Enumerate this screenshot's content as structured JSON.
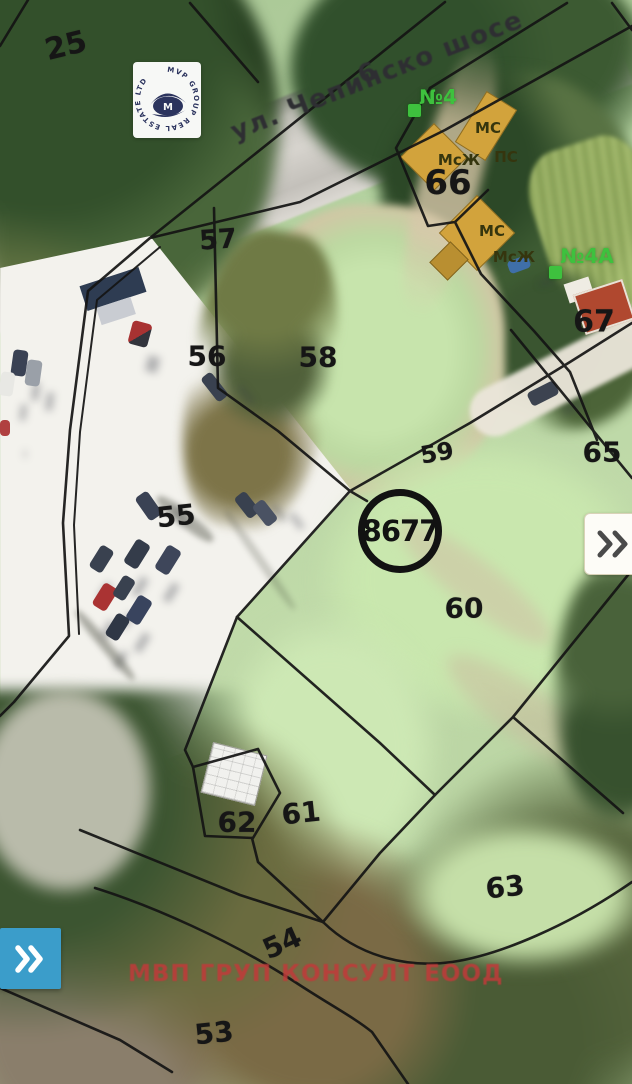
{
  "map": {
    "street_label": "ул. Чепинско шосе",
    "road_parcel_number": "6",
    "highlighted_plot": {
      "number": "8677"
    },
    "parcel_labels": [
      {
        "label": "25",
        "x": 66,
        "y": 46,
        "size": 30,
        "rot": -14
      },
      {
        "label": "57",
        "x": 218,
        "y": 240,
        "size": 27,
        "rot": -4
      },
      {
        "label": "56",
        "x": 207,
        "y": 356,
        "size": 28,
        "rot": 0
      },
      {
        "label": "58",
        "x": 318,
        "y": 357,
        "size": 28,
        "rot": 0
      },
      {
        "label": "55",
        "x": 176,
        "y": 516,
        "size": 28,
        "rot": -6
      },
      {
        "label": "59",
        "x": 437,
        "y": 453,
        "size": 24,
        "rot": -10
      },
      {
        "label": "60",
        "x": 464,
        "y": 608,
        "size": 28,
        "rot": 0
      },
      {
        "label": "62",
        "x": 237,
        "y": 822,
        "size": 28,
        "rot": 0
      },
      {
        "label": "61",
        "x": 301,
        "y": 813,
        "size": 28,
        "rot": -6
      },
      {
        "label": "63",
        "x": 505,
        "y": 887,
        "size": 28,
        "rot": -6
      },
      {
        "label": "54",
        "x": 282,
        "y": 943,
        "size": 28,
        "rot": -24
      },
      {
        "label": "53",
        "x": 214,
        "y": 1033,
        "size": 28,
        "rot": -6
      },
      {
        "label": "65",
        "x": 602,
        "y": 452,
        "size": 28,
        "rot": 0
      },
      {
        "label": "66",
        "x": 448,
        "y": 183,
        "size": 34,
        "rot": 0
      },
      {
        "label": "67",
        "x": 594,
        "y": 322,
        "size": 30,
        "rot": 0
      }
    ],
    "building_labels": [
      {
        "label": "МС",
        "x": 488,
        "y": 128
      },
      {
        "label": "ПС",
        "x": 506,
        "y": 157
      },
      {
        "label": "МсЖ",
        "x": 459,
        "y": 160
      },
      {
        "label": "МС",
        "x": 492,
        "y": 231
      },
      {
        "label": "МсЖ",
        "x": 514,
        "y": 257
      }
    ],
    "address_markers": [
      {
        "label": "№4",
        "sx": 408,
        "sy": 104,
        "tx": 438,
        "ty": 97
      },
      {
        "label": "№4А",
        "sx": 549,
        "sy": 266,
        "tx": 587,
        "ty": 256
      }
    ]
  },
  "watermark": {
    "circle_text": "MVP GROUP REAL ESTATE LTD",
    "monogram": "M",
    "footer": "МВП ГРУП КОНСУЛТ ЕООД"
  },
  "icons": {
    "expand_panel_right": "double-chevron-right",
    "expand_panel_bottom_left": "double-chevron-right",
    "logo": "house-monogram"
  },
  "colors": {
    "accent_blue": "#3b9dca",
    "marker_green": "#3ec13e",
    "footer_red": "#c13a3a",
    "boundary_black": "#141414"
  }
}
